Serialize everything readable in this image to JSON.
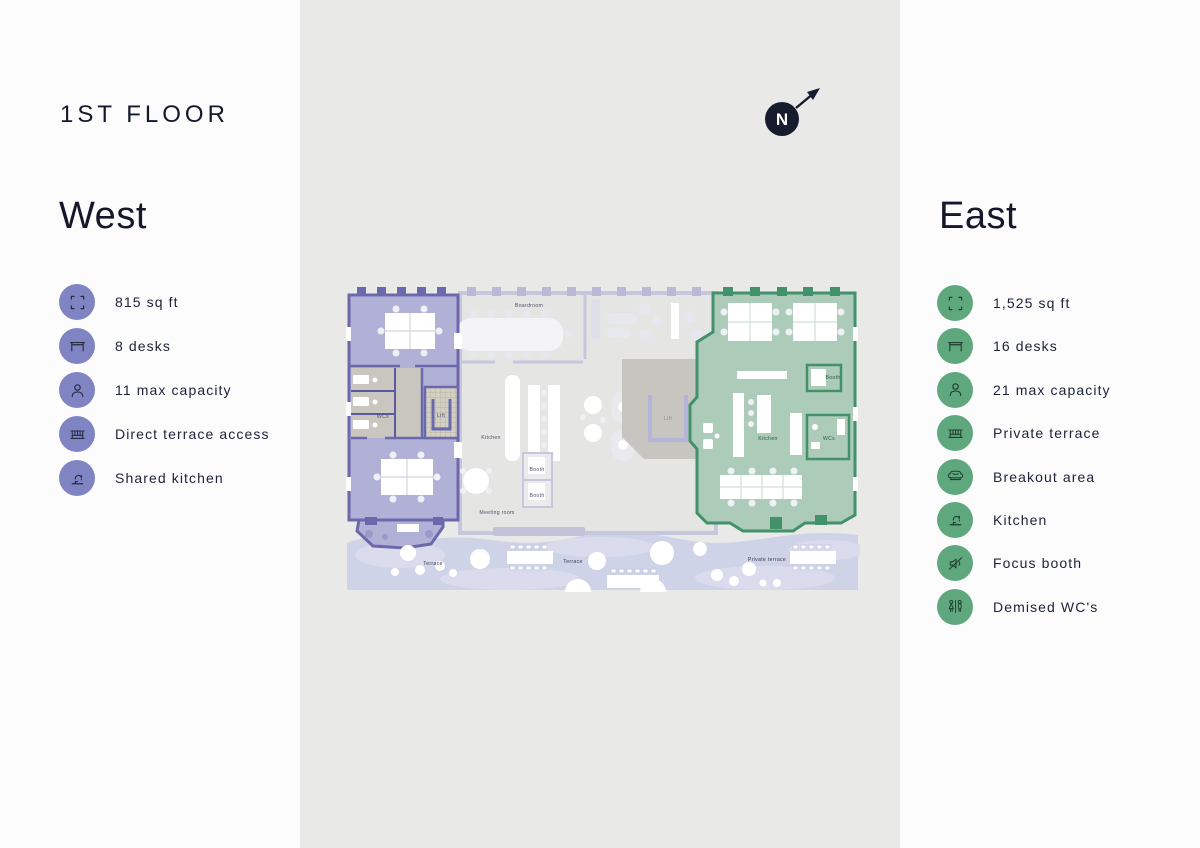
{
  "page": {
    "title": "1ST FLOOR"
  },
  "compass": {
    "label": "N"
  },
  "west": {
    "heading": "West",
    "accent": "#8184c3",
    "icon_ink": "#262b3f",
    "features": [
      {
        "icon": "icon-area",
        "label": "815 sq ft"
      },
      {
        "icon": "icon-desk",
        "label": "8 desks"
      },
      {
        "icon": "icon-person",
        "label": "11 max capacity"
      },
      {
        "icon": "icon-terrace",
        "label": "Direct terrace access"
      },
      {
        "icon": "icon-kitchen",
        "label": "Shared kitchen"
      }
    ]
  },
  "east": {
    "heading": "East",
    "accent": "#5fa77d",
    "icon_ink": "#20402f",
    "features": [
      {
        "icon": "icon-area",
        "label": "1,525 sq ft"
      },
      {
        "icon": "icon-desk",
        "label": "16 desks"
      },
      {
        "icon": "icon-person",
        "label": "21 max capacity"
      },
      {
        "icon": "icon-terrace",
        "label": "Private terrace"
      },
      {
        "icon": "icon-sofa",
        "label": "Breakout area"
      },
      {
        "icon": "icon-kitchen",
        "label": "Kitchen"
      },
      {
        "icon": "icon-focus",
        "label": "Focus booth"
      },
      {
        "icon": "icon-wc",
        "label": "Demised WC's"
      }
    ]
  },
  "floorplan": {
    "labels": {
      "boardroom": "Boardroom",
      "west_wcs": "WCs",
      "west_lift": "Lift",
      "kitchen_center": "Kitchen",
      "meeting_room": "Meeting room",
      "booth_1": "Booth",
      "booth_2": "Booth",
      "lift_center": "Lift",
      "booth_east": "Booth",
      "kitchen_east": "Kitchen",
      "wcs_east": "WCs",
      "terrace_west": "Terrace",
      "terrace_center": "Terrace",
      "terrace_east": "Private terrace"
    }
  }
}
